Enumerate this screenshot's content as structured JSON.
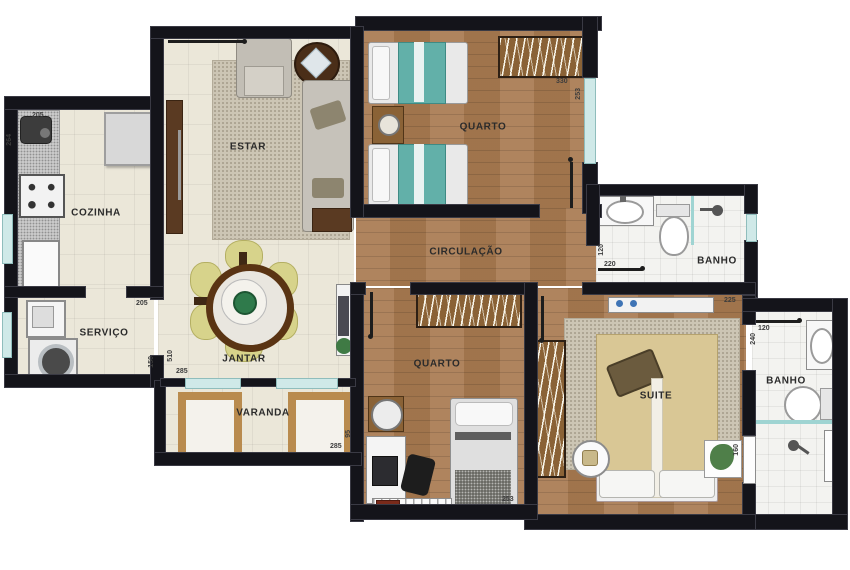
{
  "rooms": {
    "cozinha": "COZINHA",
    "servico": "SERVIÇO",
    "estar": "ESTAR",
    "jantar": "JANTAR",
    "varanda": "VARANDA",
    "quarto1": "QUARTO",
    "circulacao": "CIRCULAÇÃO",
    "quarto2": "QUARTO",
    "suite": "SUITE",
    "banho1": "BANHO",
    "banho2": "BANHO"
  },
  "dims": {
    "cozinha_w": "205",
    "cozinha_h": "264",
    "servico_w": "205",
    "servico_h": "150",
    "jantar_h": "510",
    "jantar_w": "285",
    "varanda_w": "285",
    "varanda_h": "95",
    "quarto1_w": "330",
    "quarto1_h": "253",
    "quarto2_w": "253",
    "banho1_h": "120",
    "banho1_w": "220",
    "suite_w": "225",
    "suite_h": "160",
    "banho2_w": "120",
    "banho2_h": "240"
  },
  "colors": {
    "wall": "#14141a",
    "wood_floor": "#a87a50",
    "cream_tile": "#ebe7d9",
    "bath_tile": "#f3f3f0",
    "teal_bed": "#62b0a9",
    "window_glass": "#cfe9e8",
    "dining_chair": "#d7d38b",
    "suite_blanket": "#d9c795"
  }
}
